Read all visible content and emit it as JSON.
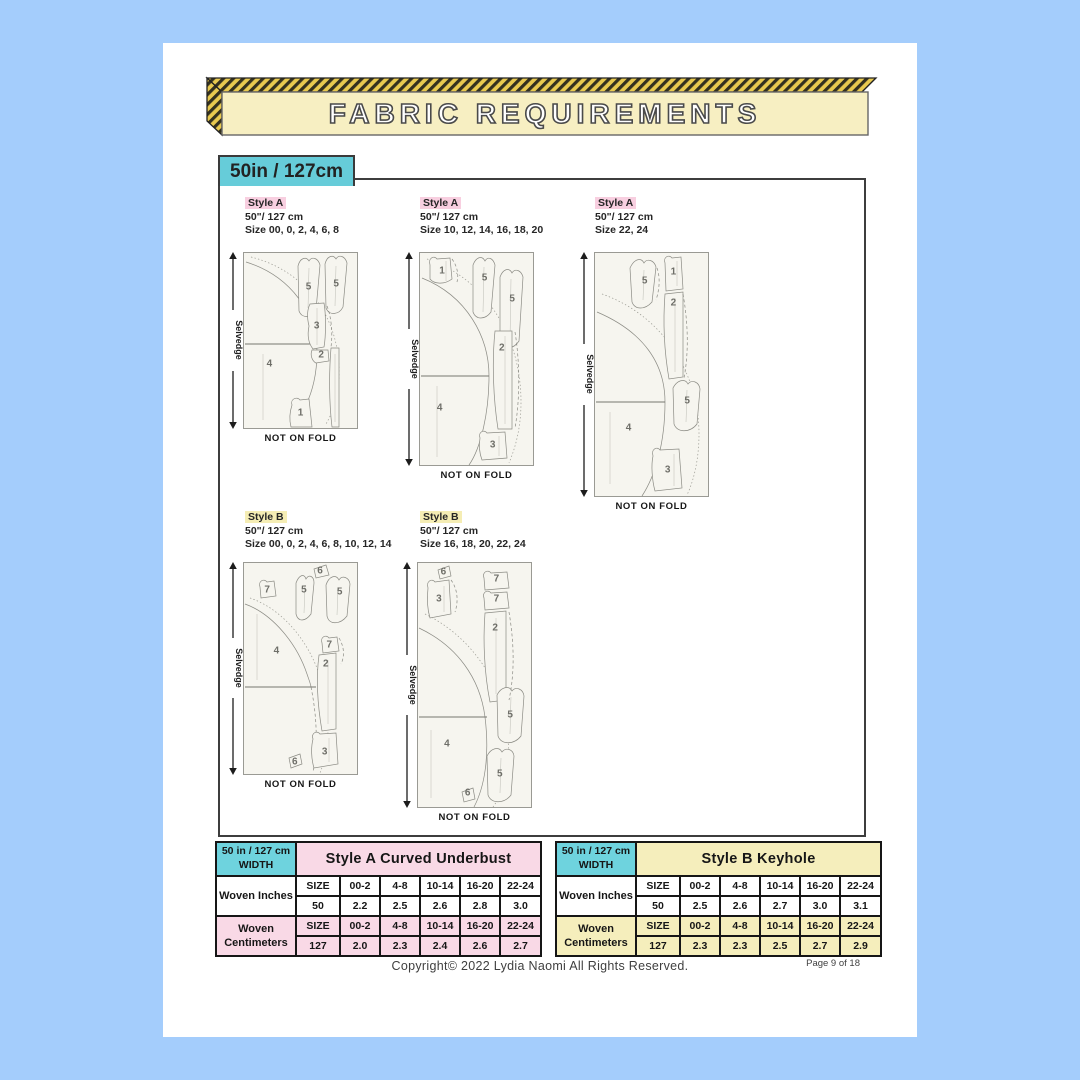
{
  "page": {
    "title": "FABRIC REQUIREMENTS",
    "width_badge": "50in / 127cm",
    "footer": {
      "copyright": "Copyright© 2022  Lydia Naomi  All Rights Reserved.",
      "page_number": "Page 9 of 18"
    }
  },
  "colors": {
    "background_blue": "#a4cdfc",
    "banner_yellow": "#f7efc2",
    "banner_hatch_yellow": "#e8c94f",
    "badge_teal": "#66ccd9",
    "table_header_teal": "#6ed3de",
    "style_a_pink": "#f8cfe0",
    "style_b_yellow": "#f5edb4",
    "table_a_pink": "#f9d9e6",
    "table_b_yellow": "#f5eebc"
  },
  "diagrams": [
    {
      "style_label": "Style A",
      "width_label": "50\"/ 127 cm",
      "sizes_label": "Size 00, 0, 2, 4, 6, 8",
      "selvedge_label": "Selvedge",
      "fold_label": "NOT ON FOLD",
      "pieces": [
        {
          "n": "5",
          "x": 57,
          "y": 20
        },
        {
          "n": "5",
          "x": 81,
          "y": 18
        },
        {
          "n": "3",
          "x": 64,
          "y": 42
        },
        {
          "n": "2",
          "x": 68,
          "y": 58
        },
        {
          "n": "4",
          "x": 23,
          "y": 63
        },
        {
          "n": "1",
          "x": 50,
          "y": 91
        }
      ]
    },
    {
      "style_label": "Style A",
      "width_label": "50\"/ 127 cm",
      "sizes_label": "Size 10, 12, 14, 16, 18, 20",
      "selvedge_label": "Selvedge",
      "fold_label": "NOT ON FOLD",
      "pieces": [
        {
          "n": "1",
          "x": 20,
          "y": 9
        },
        {
          "n": "5",
          "x": 57,
          "y": 12
        },
        {
          "n": "5",
          "x": 81,
          "y": 22
        },
        {
          "n": "2",
          "x": 72,
          "y": 45
        },
        {
          "n": "4",
          "x": 18,
          "y": 73
        },
        {
          "n": "3",
          "x": 64,
          "y": 90
        }
      ]
    },
    {
      "style_label": "Style A",
      "width_label": "50\"/ 127 cm",
      "sizes_label": "Size 22, 24",
      "selvedge_label": "Selvedge",
      "fold_label": "NOT ON FOLD",
      "pieces": [
        {
          "n": "5",
          "x": 44,
          "y": 12
        },
        {
          "n": "1",
          "x": 69,
          "y": 8
        },
        {
          "n": "2",
          "x": 69,
          "y": 21
        },
        {
          "n": "5",
          "x": 81,
          "y": 61
        },
        {
          "n": "4",
          "x": 30,
          "y": 72
        },
        {
          "n": "3",
          "x": 64,
          "y": 89
        }
      ]
    },
    {
      "style_label": "Style B",
      "width_label": "50\"/ 127 cm",
      "sizes_label": "Size 00, 0, 2, 4, 6, 8, 10, 12, 14",
      "selvedge_label": "Selvedge",
      "fold_label": "NOT ON FOLD",
      "pieces": [
        {
          "n": "7",
          "x": 21,
          "y": 13
        },
        {
          "n": "6",
          "x": 67,
          "y": 4
        },
        {
          "n": "5",
          "x": 53,
          "y": 13
        },
        {
          "n": "5",
          "x": 84,
          "y": 14
        },
        {
          "n": "4",
          "x": 29,
          "y": 42
        },
        {
          "n": "7",
          "x": 75,
          "y": 39
        },
        {
          "n": "2",
          "x": 72,
          "y": 48
        },
        {
          "n": "3",
          "x": 71,
          "y": 89
        },
        {
          "n": "6",
          "x": 45,
          "y": 94
        }
      ]
    },
    {
      "style_label": "Style B",
      "width_label": "50\"/ 127 cm",
      "sizes_label": "Size 16, 18, 20, 22, 24",
      "selvedge_label": "Selvedge",
      "fold_label": "NOT ON FOLD",
      "pieces": [
        {
          "n": "6",
          "x": 23,
          "y": 4
        },
        {
          "n": "3",
          "x": 19,
          "y": 15
        },
        {
          "n": "7",
          "x": 69,
          "y": 7
        },
        {
          "n": "7",
          "x": 69,
          "y": 15
        },
        {
          "n": "2",
          "x": 68,
          "y": 27
        },
        {
          "n": "4",
          "x": 26,
          "y": 74
        },
        {
          "n": "5",
          "x": 81,
          "y": 62
        },
        {
          "n": "5",
          "x": 72,
          "y": 86
        },
        {
          "n": "6",
          "x": 44,
          "y": 94
        }
      ]
    }
  ],
  "tables": [
    {
      "width_label": "50 in / 127 cm",
      "width_label2": "WIDTH",
      "title": "Style A  Curved Underbust",
      "accent": "#f9d9e6",
      "groups": [
        {
          "label": "Woven Inches",
          "tint": false,
          "size_row": [
            "SIZE",
            "00-2",
            "4-8",
            "10-14",
            "16-20",
            "22-24"
          ],
          "value_row": [
            "50",
            "2.2",
            "2.5",
            "2.6",
            "2.8",
            "3.0"
          ]
        },
        {
          "label": "Woven Centimeters",
          "tint": true,
          "size_row": [
            "SIZE",
            "00-2",
            "4-8",
            "10-14",
            "16-20",
            "22-24"
          ],
          "value_row": [
            "127",
            "2.0",
            "2.3",
            "2.4",
            "2.6",
            "2.7"
          ]
        }
      ]
    },
    {
      "width_label": "50 in / 127 cm",
      "width_label2": "WIDTH",
      "title": "Style B Keyhole",
      "accent": "#f5eebc",
      "groups": [
        {
          "label": "Woven Inches",
          "tint": false,
          "size_row": [
            "SIZE",
            "00-2",
            "4-8",
            "10-14",
            "16-20",
            "22-24"
          ],
          "value_row": [
            "50",
            "2.5",
            "2.6",
            "2.7",
            "3.0",
            "3.1"
          ]
        },
        {
          "label": "Woven Centimeters",
          "tint": true,
          "size_row": [
            "SIZE",
            "00-2",
            "4-8",
            "10-14",
            "16-20",
            "22-24"
          ],
          "value_row": [
            "127",
            "2.3",
            "2.3",
            "2.5",
            "2.7",
            "2.9"
          ]
        }
      ]
    }
  ]
}
